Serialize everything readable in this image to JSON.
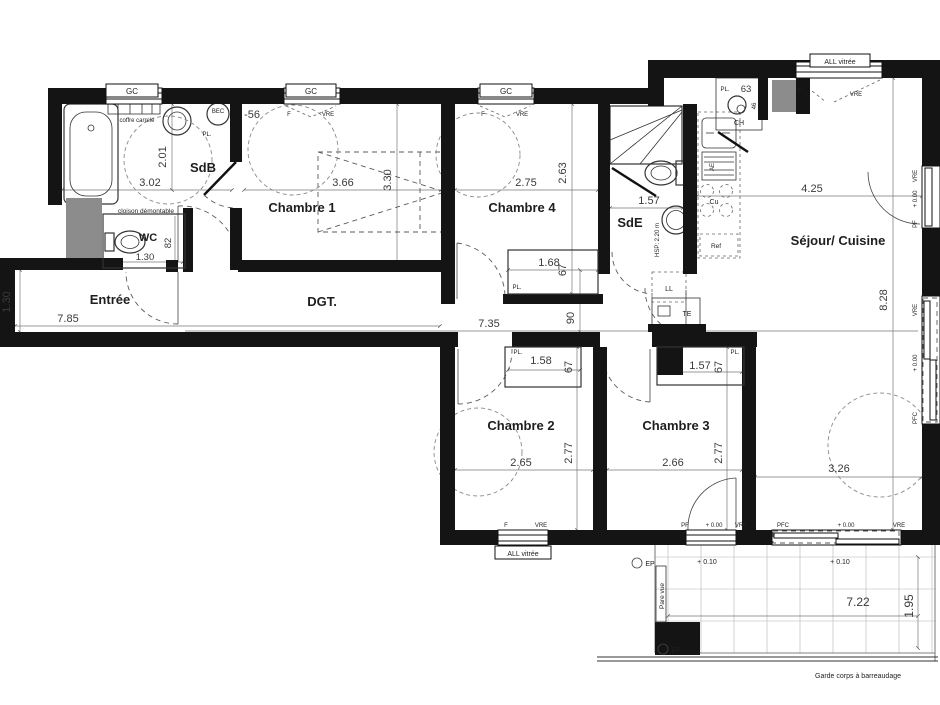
{
  "rooms": {
    "sdb": "SdB",
    "chambre1": "Chambre 1",
    "chambre4": "Chambre 4",
    "sde": "SdE",
    "sejour": "Séjour/ Cuisine",
    "wc": "WC",
    "entree": "Entrée",
    "dgt": "DGT.",
    "chambre2": "Chambre 2",
    "chambre3": "Chambre 3"
  },
  "dims": {
    "sdb_w": "3.02",
    "sdb_h": "2.01",
    "door_sdb": "-56",
    "c1_w": "3.66",
    "c1_h": "3.30",
    "c4_w": "2.75",
    "c4_h": "2.63",
    "c4_pl_w": "1.68",
    "c4_pl_d": "67",
    "sde_w": "1.57",
    "sejour_w": "4.25",
    "sejour_h": "8.28",
    "sejour_w2": "3.26",
    "wc_w": "1.30",
    "wc_d": "82",
    "entree_h": "1.30",
    "entree_w": "7.85",
    "dgt_l": "7.35",
    "dgt_w": "90",
    "c2_pl_w": "1.58",
    "c2_pl_d": "67",
    "c2_w": "2.65",
    "c2_h": "2.77",
    "c3_pl_w": "1.57",
    "c3_pl_d": "67",
    "c3_w": "2.66",
    "c3_h": "2.77",
    "balcon_w": "7.22",
    "balcon_d": "1.95",
    "pl_cuisine": "63",
    "ch_d": "46"
  },
  "levels": {
    "zero": "+ 0.00",
    "balcon": "+ 0.10"
  },
  "ann": {
    "gc": "GC",
    "all_vitree": "ALL vitrée",
    "coffre": "coffre carrelé",
    "cloison": "cloison démontable",
    "pl": "PL.",
    "bec": "BEC",
    "cu": "Cu",
    "ref": "Ref",
    "ll": "LL",
    "te": "TE",
    "ae": "AE",
    "ch": "CH",
    "hsp": "HSP: 2.20 m",
    "pare_vue": "Pare vue",
    "ep": "EP",
    "garde_corps": "Garde corps à barreaudage",
    "f": "F",
    "vre": "VRE",
    "pf": "PF",
    "pfc": "PFC"
  }
}
